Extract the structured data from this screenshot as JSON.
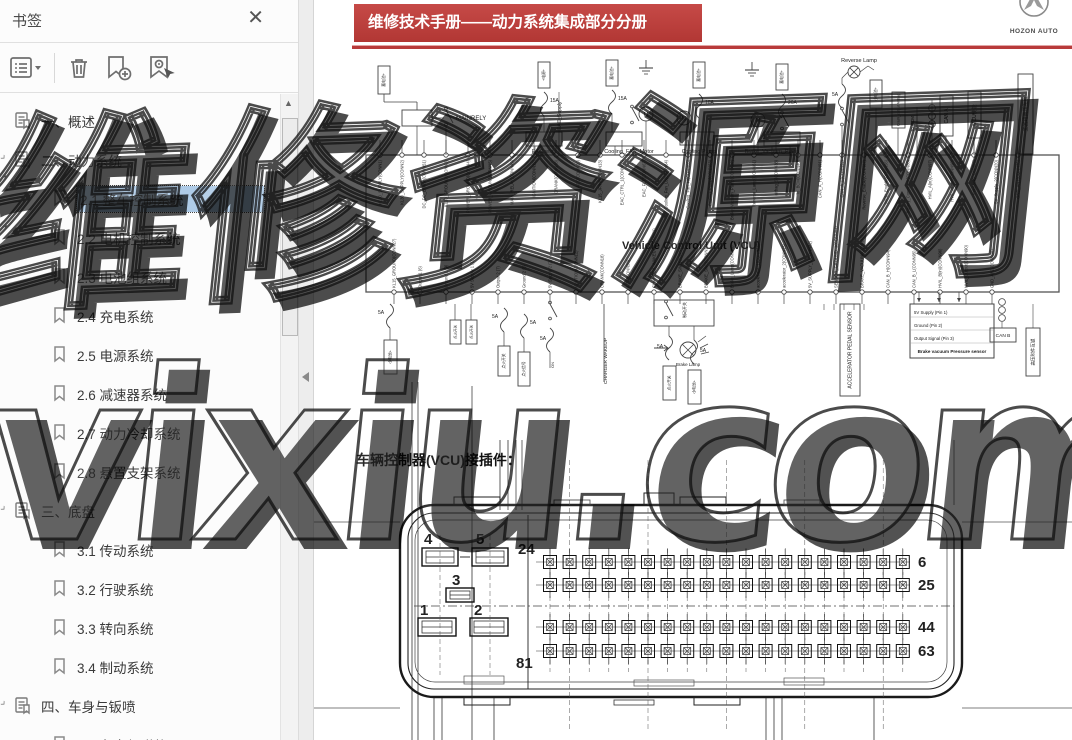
{
  "sidebar": {
    "title": "书签",
    "close_label": "✕",
    "toolbar": [
      "bookmark-list-menu",
      "delete-bookmark",
      "add-bookmark",
      "locate-current-bookmark"
    ],
    "items": [
      {
        "label": "一、概述",
        "level": 0,
        "parent": true,
        "expanded": false,
        "selected": false
      },
      {
        "label": "二、动力系统",
        "level": 0,
        "parent": true,
        "expanded": true,
        "selected": false
      },
      {
        "label": "2.1 整车控制系统",
        "level": 1,
        "parent": false,
        "selected": true
      },
      {
        "label": "2.2 电机控制系统",
        "level": 1,
        "parent": false,
        "selected": false
      },
      {
        "label": "2.3 电池组系统",
        "level": 1,
        "parent": false,
        "selected": false
      },
      {
        "label": "2.4 充电系统",
        "level": 1,
        "parent": false,
        "selected": false
      },
      {
        "label": "2.5 电源系统",
        "level": 1,
        "parent": false,
        "selected": false
      },
      {
        "label": "2.6 减速器系统",
        "level": 1,
        "parent": false,
        "selected": false
      },
      {
        "label": "2.7 动力冷却系统",
        "level": 1,
        "parent": false,
        "selected": false
      },
      {
        "label": "2.8 悬置支架系统",
        "level": 1,
        "parent": false,
        "selected": false
      },
      {
        "label": "三、底盘",
        "level": 0,
        "parent": true,
        "expanded": true,
        "selected": false
      },
      {
        "label": "3.1 传动系统",
        "level": 1,
        "parent": false,
        "selected": false
      },
      {
        "label": "3.2 行驶系统",
        "level": 1,
        "parent": false,
        "selected": false
      },
      {
        "label": "3.3 转向系统",
        "level": 1,
        "parent": false,
        "selected": false
      },
      {
        "label": "3.4 制动系统",
        "level": 1,
        "parent": false,
        "selected": false
      },
      {
        "label": "四、车身与钣喷",
        "level": 0,
        "parent": true,
        "expanded": true,
        "selected": false
      },
      {
        "label": "4.1 车身与附件",
        "level": 1,
        "parent": false,
        "selected": false
      }
    ]
  },
  "document": {
    "header": "维修技术手册——动力系统集成部分分册",
    "logo_text": "HOZON AUTO",
    "connector_caption": "车辆控制器(VCU)接插件：",
    "schematic": {
      "vcu_label": "Vehicle Control Unit (VCU)",
      "labels": {
        "main_relay": "MAINRELY",
        "eac_supply": "EAC_Supply",
        "eac_relay": "EAC relay",
        "cooling_fan": "Cooling_FAN_Motor",
        "cooling_pump": "Cooling Pump",
        "brake_vacuum_pump": "Brake_Vacuum_Pump",
        "reverse_lamp": "Reverse Lamp",
        "brake_lamp": "Brake Lamp",
        "charger_wakeup": "CHARGER WAKEUP",
        "to_bcm": "To BCM",
        "can_a": "CAN A",
        "can_b": "CAN B",
        "mcu_enable": "MCU使能",
        "main_hvil": "主回路高压互锁",
        "acc_hvil": "高压附件互锁",
        "accel_sensor": "ACCELERATOR PEDAL SENSOR",
        "bvp_sensor": "Brake vacuum Pressure sensor",
        "airbag": "Crash_output AirBag",
        "brake_sw": "制动开关",
        "battery": "蓄电池+",
        "battery_small": "小电池+",
        "supply": "+电源+",
        "ign_switch": "点火开关",
        "ign_signal": "点火信号",
        "on": "ON",
        "motor": "M"
      },
      "fuse_values": [
        "15A",
        "15A",
        "10A",
        "20A",
        "5A",
        "5A",
        "5A",
        "5A",
        "5A",
        "5A"
      ],
      "sensor_pin_rows": [
        "5V Supply (Pin 1)",
        "Ground (Pin 2)",
        "Output Signal (Pin 3)"
      ],
      "top_pins": [
        "KL30_SUPPLY(CONN1)",
        "KL30_SUPPLY(CONN2)",
        "DC_DC_Enable(CONN51)",
        "KL30_GROUND(CONN3)",
        "POWER_GROUND(CONN4)",
        "POWER_GROUND(CONN5)",
        "MAIN_RELAY(CONN49)",
        "IGNITION(CONN12)",
        "CRANK(CONN18)",
        "ACC(CONN20)",
        "KL15_JP/HR(CONN13)",
        "EAC_CTRL_1(CONN66)",
        "EAC_FLT(CONN67)",
        "Cooling_Fan_Lo(CONN64)",
        "Cooling_Fan_Hi(CONN65)",
        "Cooling_Pump(CONN63)",
        "Brake_Vacuum_Pump(CONN62)",
        "Reverse_Lamp(CONN61)",
        "airbag_S(CONN38)",
        "To_BCM(CONN40)",
        "CAN_A_H(CONN91)",
        "CAN_A_L(CONN92)",
        "Reverse_Enable(CONN87)",
        "MCU_Enable(CONN56)",
        "Battery_Connector(CONN88)",
        "HVIL_A(in)(CONN97)",
        "HVIL_A(out)(CONN98)",
        "Interlock(CONN89)",
        "5V_Supply_2(CONN20)",
        "GND_AN1(CONN35)"
      ],
      "bottom_pins": [
        "KL15_GROUND(CONN27)",
        "Output 1 (6)",
        "Ground 1 (9)",
        "5V Supply 1 (1)",
        "Output 2 (7)",
        "Ground 2 (8)",
        "5V Supply 2 (2)",
        "IGNITION(CONN12)",
        "CRANK(CONN18)",
        "ACC(CONN20)",
        "CHARGER_WAKEUP(CONN21)",
        "BRAKE_SW1(CONN10)",
        "BRAKE_SW2(CONN11)",
        "Brake_Lamp(CONN60)",
        "accelerator_1(CONN14)",
        "accelerator_2(CONN15)",
        "5V_SUPPLY_1(CONN82)",
        "SENSOR_GROUND_1(CONN84)",
        "BRAKE_VACUUM(CONN93)",
        "CAN_B_H(CONN94)",
        "CAN_B_L(CONN95)",
        "HVIL_B(in)(CONN96)",
        "HVIL_Output(CONN90)",
        "GND_AN2(CONN36)"
      ]
    },
    "connector": {
      "large_pin_labels": [
        "4",
        "5",
        "3",
        "1",
        "2"
      ],
      "grid": {
        "rows": 4,
        "cols": 19,
        "label_top_left": "24",
        "label_bottom_left": "81",
        "row_right_labels": [
          "6",
          "25",
          "44",
          "63"
        ]
      }
    }
  },
  "watermark": {
    "line1": "维修资源网",
    "line2": "vixiu.com"
  }
}
